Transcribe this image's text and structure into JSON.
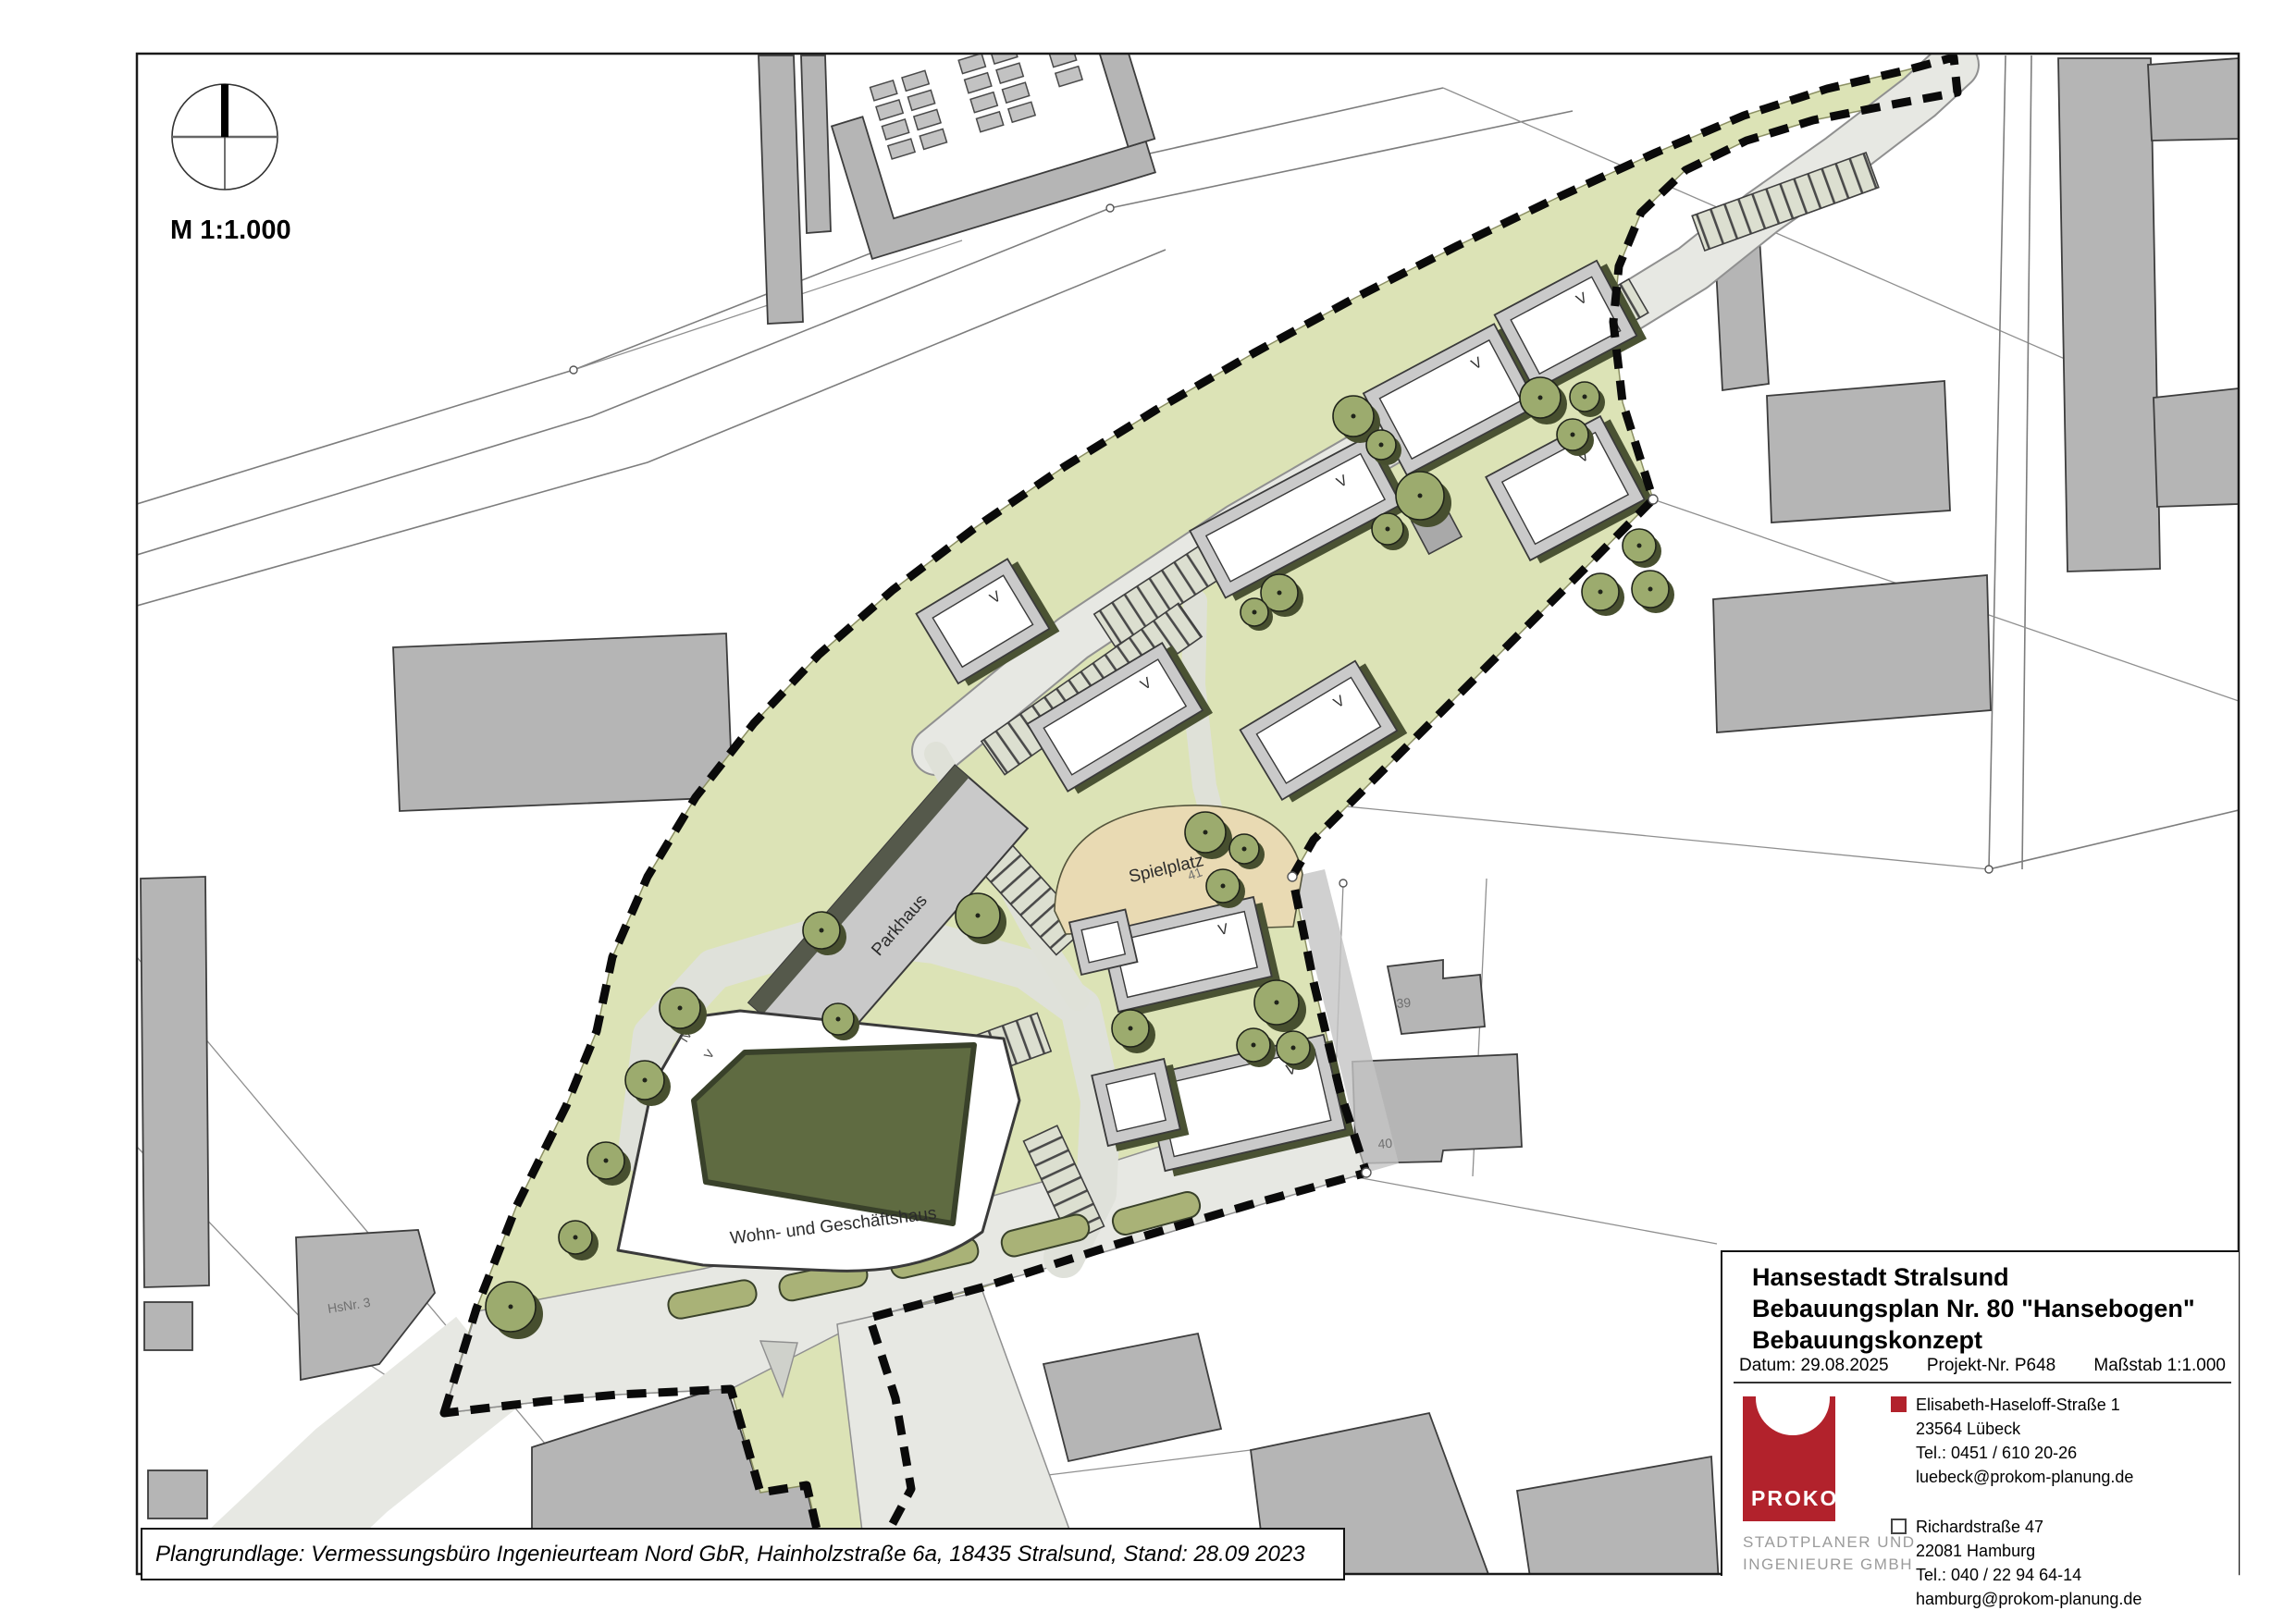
{
  "compass": {
    "scale_label": "M 1:1.000"
  },
  "plan": {
    "labels": {
      "parkhaus": "Parkhaus",
      "spielplatz": "Spielplatz",
      "wohn_geschaeftshaus": "Wohn- und Geschäftshaus",
      "hsnr3": "HsNr. 3",
      "storeys_iv": "IV",
      "storeys_v": "V",
      "parcel_39": "39",
      "parcel_40": "40",
      "parcel_41": "41"
    },
    "story_marker": "V",
    "colors": {
      "site_green": "#dce3b6",
      "road_gray": "#e7e8e3",
      "existing_building": "#b5b5b5",
      "tree_olive": "#9cab6e",
      "shadow_olive": "#4a5233",
      "courtyard_olive": "#5f6b41",
      "playground_beige": "#e9dab3",
      "boundary_black": "#0a0a0a"
    }
  },
  "source_note": {
    "text": "Plangrundlage: Vermessungsbüro Ingenieurteam Nord GbR, Hainholzstraße 6a, 18435 Stralsund, Stand: 28.09 2023"
  },
  "title_block": {
    "line1": "Hansestadt Stralsund",
    "line2": "Bebauungsplan Nr. 80 \"Hansebogen\"",
    "line3": "Bebauungskonzept",
    "date_label": "Datum: 29.08.2025",
    "project_label": "Projekt-Nr. P648",
    "scale_label": "Maßstab 1:1.000",
    "logo": {
      "name": "PROKOM",
      "subline1": "STADTPLANER UND",
      "subline2": "INGENIEURE GMBH",
      "color": "#b2222c"
    },
    "office1": {
      "street": "Elisabeth-Haseloff-Straße 1",
      "city": "23564 Lübeck",
      "tel": "Tel.: 0451 / 610 20-26",
      "email": "luebeck@prokom-planung.de"
    },
    "office2": {
      "street": "Richardstraße 47",
      "city": "22081 Hamburg",
      "tel": "Tel.: 040 / 22 94 64-14",
      "email": "hamburg@prokom-planung.de"
    }
  }
}
